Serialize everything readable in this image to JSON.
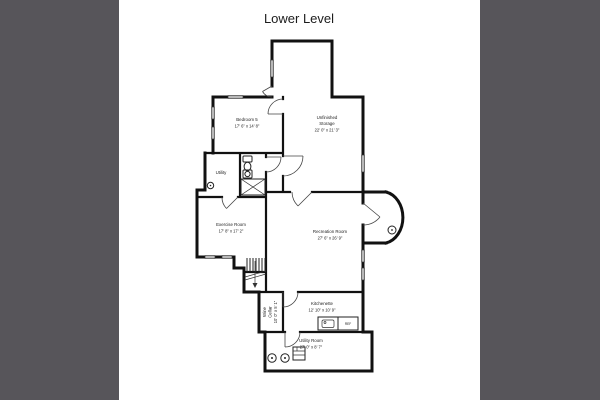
{
  "title": "Lower Level",
  "colors": {
    "side_panel": "#57555A",
    "background": "#FFFFFF",
    "wall": "#111111",
    "text": "#222222"
  },
  "rooms": {
    "bedroom5": {
      "name": "Bedroom 5",
      "dims": "17' 6\" x 14' 8\""
    },
    "storage": {
      "name_line1": "Unfinished",
      "name_line2": "Storage",
      "dims": "22' 0\" x 21' 3\""
    },
    "utility_small": {
      "name": "Utility"
    },
    "exercise": {
      "name": "Exercise Room",
      "dims": "17' 8\" x 17' 2\""
    },
    "recreation": {
      "name": "Recreation Room",
      "dims": "27' 6\" x 26' 9\""
    },
    "wine_cellar": {
      "name_line1": "Wine",
      "name_line2": "Cellar",
      "dims": "10' 0\" x 5' 1\""
    },
    "kitchenette": {
      "name": "Kitchenette",
      "dims": "12' 10\" x 10' 9\""
    },
    "utility_room": {
      "name": "Utility Room",
      "dims": "27' 0\" x 8' 7\""
    }
  },
  "fixtures": {
    "refrigerator_label": "REF"
  }
}
